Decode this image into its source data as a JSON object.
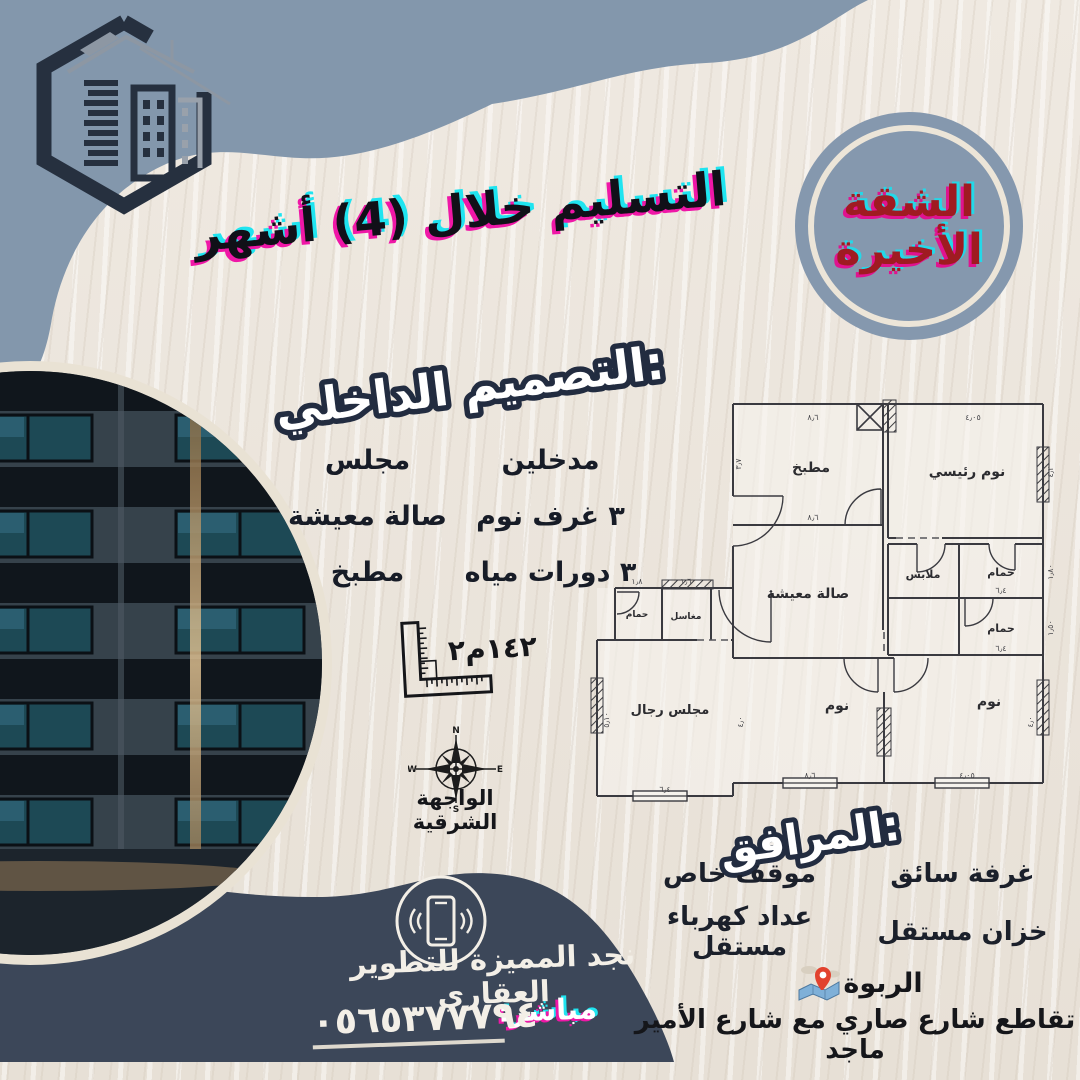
{
  "colors": {
    "blue_blob": "#8397ac",
    "navy_blob": "#3c4759",
    "logo_navy": "#26303f",
    "red": "#9f1b21",
    "magenta": "#ef17a7",
    "cyan": "#1fe4f0",
    "cream": "#e9e2d4",
    "background": "#ebe5dc"
  },
  "header": {
    "delivery_text": "التسليم خلال (4) أشهر",
    "badge_line1": "الشقة",
    "badge_line2": "الأخيرة"
  },
  "interior": {
    "title": "التصميم الداخلي:",
    "items": [
      "مدخلين",
      "مجلس",
      "٣ غرف نوم",
      "صالة معيشة",
      "٣ دورات مياه",
      "مطبخ"
    ]
  },
  "area_value": "١٤٢م٢",
  "compass": {
    "n": "N",
    "e": "E",
    "s": "S",
    "w": "W",
    "caption": "الواجهة الشرقية"
  },
  "floor_plan": {
    "rooms": [
      "مطبخ",
      "نوم رئيسي",
      "صالة معيشة",
      "ملابس",
      "حمام",
      "حمام",
      "مغاسل",
      "حمام",
      "مجلس رجال",
      "نوم",
      "نوم"
    ],
    "dimensions": [
      "٨٫٦",
      "٤٫٠٥",
      "٣٫٧",
      "٤٫٢",
      "٨٫٦",
      "١٫٨٠",
      "٦٫٤",
      "١٫٥٠",
      "٦٫٤",
      "٥٫١٠",
      "٦٫٤",
      "٨٫٦",
      "٤٫٠",
      "٤٫٠٥",
      "٤٫٠",
      "١٫٦",
      "١٫٨"
    ]
  },
  "facilities": {
    "title": "المرافق:",
    "items": [
      "غرفة سائق",
      "موقف خاص",
      "خزان مستقل",
      "عداد كهرباء مستقل"
    ]
  },
  "location": {
    "district": "الربوة",
    "address": "تقاطع شارع صاري مع شارع الأمير ماجد"
  },
  "footer": {
    "company": "نجد المميزة للتطوير العقاري",
    "direct_label": "مباشر:",
    "phone": "٠٥٦٥٣٧٧٧٩٤"
  }
}
